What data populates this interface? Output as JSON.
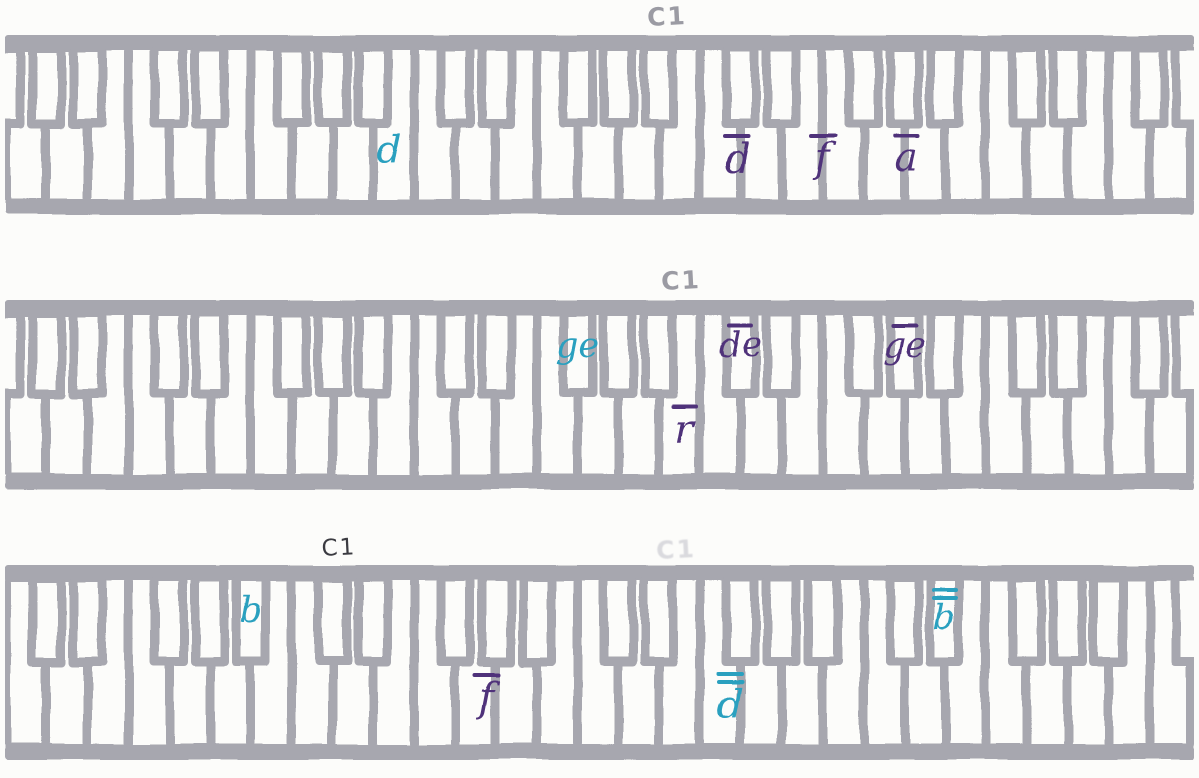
{
  "document": {
    "type": "scanned hand-drawn piano keyboard worksheet",
    "rows_count": 3
  },
  "palette": {
    "paper": "#fcfcfa",
    "marker_gray": "#a7a7af",
    "pencil_gray": "#9b9ba3",
    "pen_dark": "#3b3b41",
    "erased_gray": "#dadade",
    "teal_ink": "#2aa0bf",
    "purple_ink": "#50307a"
  },
  "keyboards": [
    {
      "name": "keyboard-1",
      "octave_marks": [
        {
          "text": "C1",
          "style": "gray",
          "x_pct": 55.6
        }
      ],
      "notes": [
        {
          "text": "d",
          "bars": 0,
          "color": "teal",
          "key": "white",
          "x_pct": 32.5
        },
        {
          "text": "d",
          "bars": 1,
          "color": "purple",
          "key": "white",
          "x_pct": 61.5
        },
        {
          "text": "f",
          "bars": 1,
          "color": "purple",
          "key": "white",
          "x_pct": 68.6
        },
        {
          "text": "a",
          "bars": 1,
          "color": "purple",
          "key": "white",
          "x_pct": 75.6
        }
      ]
    },
    {
      "name": "keyboard-2",
      "octave_marks": [
        {
          "text": "C1",
          "style": "gray",
          "x_pct": 56.8
        }
      ],
      "notes": [
        {
          "text": "ge",
          "bars": 0,
          "color": "teal",
          "key": "black",
          "x_pct": 46.5
        },
        {
          "text": "r",
          "bars": 1,
          "color": "purple",
          "key": "white",
          "x_pct": 57.1
        },
        {
          "text": "de",
          "bars": 1,
          "color": "purple",
          "key": "black",
          "x_pct": 63.2
        },
        {
          "text": "ge",
          "bars": 1,
          "color": "purple",
          "key": "black",
          "x_pct": 75.2
        }
      ]
    },
    {
      "name": "keyboard-3",
      "octave_marks": [
        {
          "text": "C1",
          "style": "dark",
          "x_pct": 28.3
        },
        {
          "text": "C1",
          "style": "erased",
          "x_pct": 56.4
        }
      ],
      "notes": [
        {
          "text": "b",
          "bars": 0,
          "color": "teal",
          "key": "black",
          "x_pct": 23.6
        },
        {
          "text": "f",
          "bars": 1,
          "color": "purple",
          "key": "white",
          "x_pct": 40.6
        },
        {
          "text": "d",
          "bars": 2,
          "color": "teal",
          "key": "white",
          "x_pct": 60.9
        },
        {
          "text": "b",
          "bars": 2,
          "color": "teal",
          "key": "black",
          "x_pct": 78.8
        }
      ]
    }
  ]
}
